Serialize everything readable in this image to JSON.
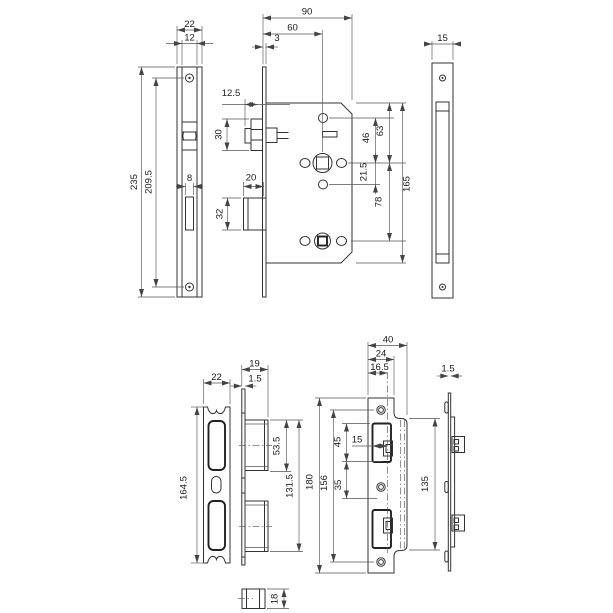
{
  "colors": {
    "background": "#ffffff",
    "line": "#333333",
    "text": "#1a1a1a"
  },
  "dims": {
    "fp_w": "22",
    "fp_iw": "12",
    "fp_h": "235",
    "fp_screws": "209.5",
    "fp_slot": "8",
    "body_depth": "90",
    "backset": "60",
    "fp_thk": "3",
    "latch_proj": "12.5",
    "latch_h": "30",
    "bolt_w": "20",
    "bolt_h": "32",
    "top_to_spindle": "63",
    "hole_to_spindle": "46",
    "spindle_to_hole": "21.5",
    "spindle_to_cyl": "78",
    "case_h": "165",
    "case_w": "15",
    "s1_w": "22",
    "s1_h": "164.5",
    "s1_depth": "19",
    "s1_thk": "1.5",
    "s1_box": "53.5",
    "s1_span": "131.5",
    "s2_flange_w": "40",
    "s2_w": "24",
    "s2_lip_off": "16.5",
    "s2_h": "180",
    "s2_screws": "156",
    "s2_open1": "45",
    "s2_gap": "35",
    "s2_lip": "15",
    "s2_flange_h": "135",
    "s2_thk": "1.5",
    "latch_face_h": "18"
  }
}
